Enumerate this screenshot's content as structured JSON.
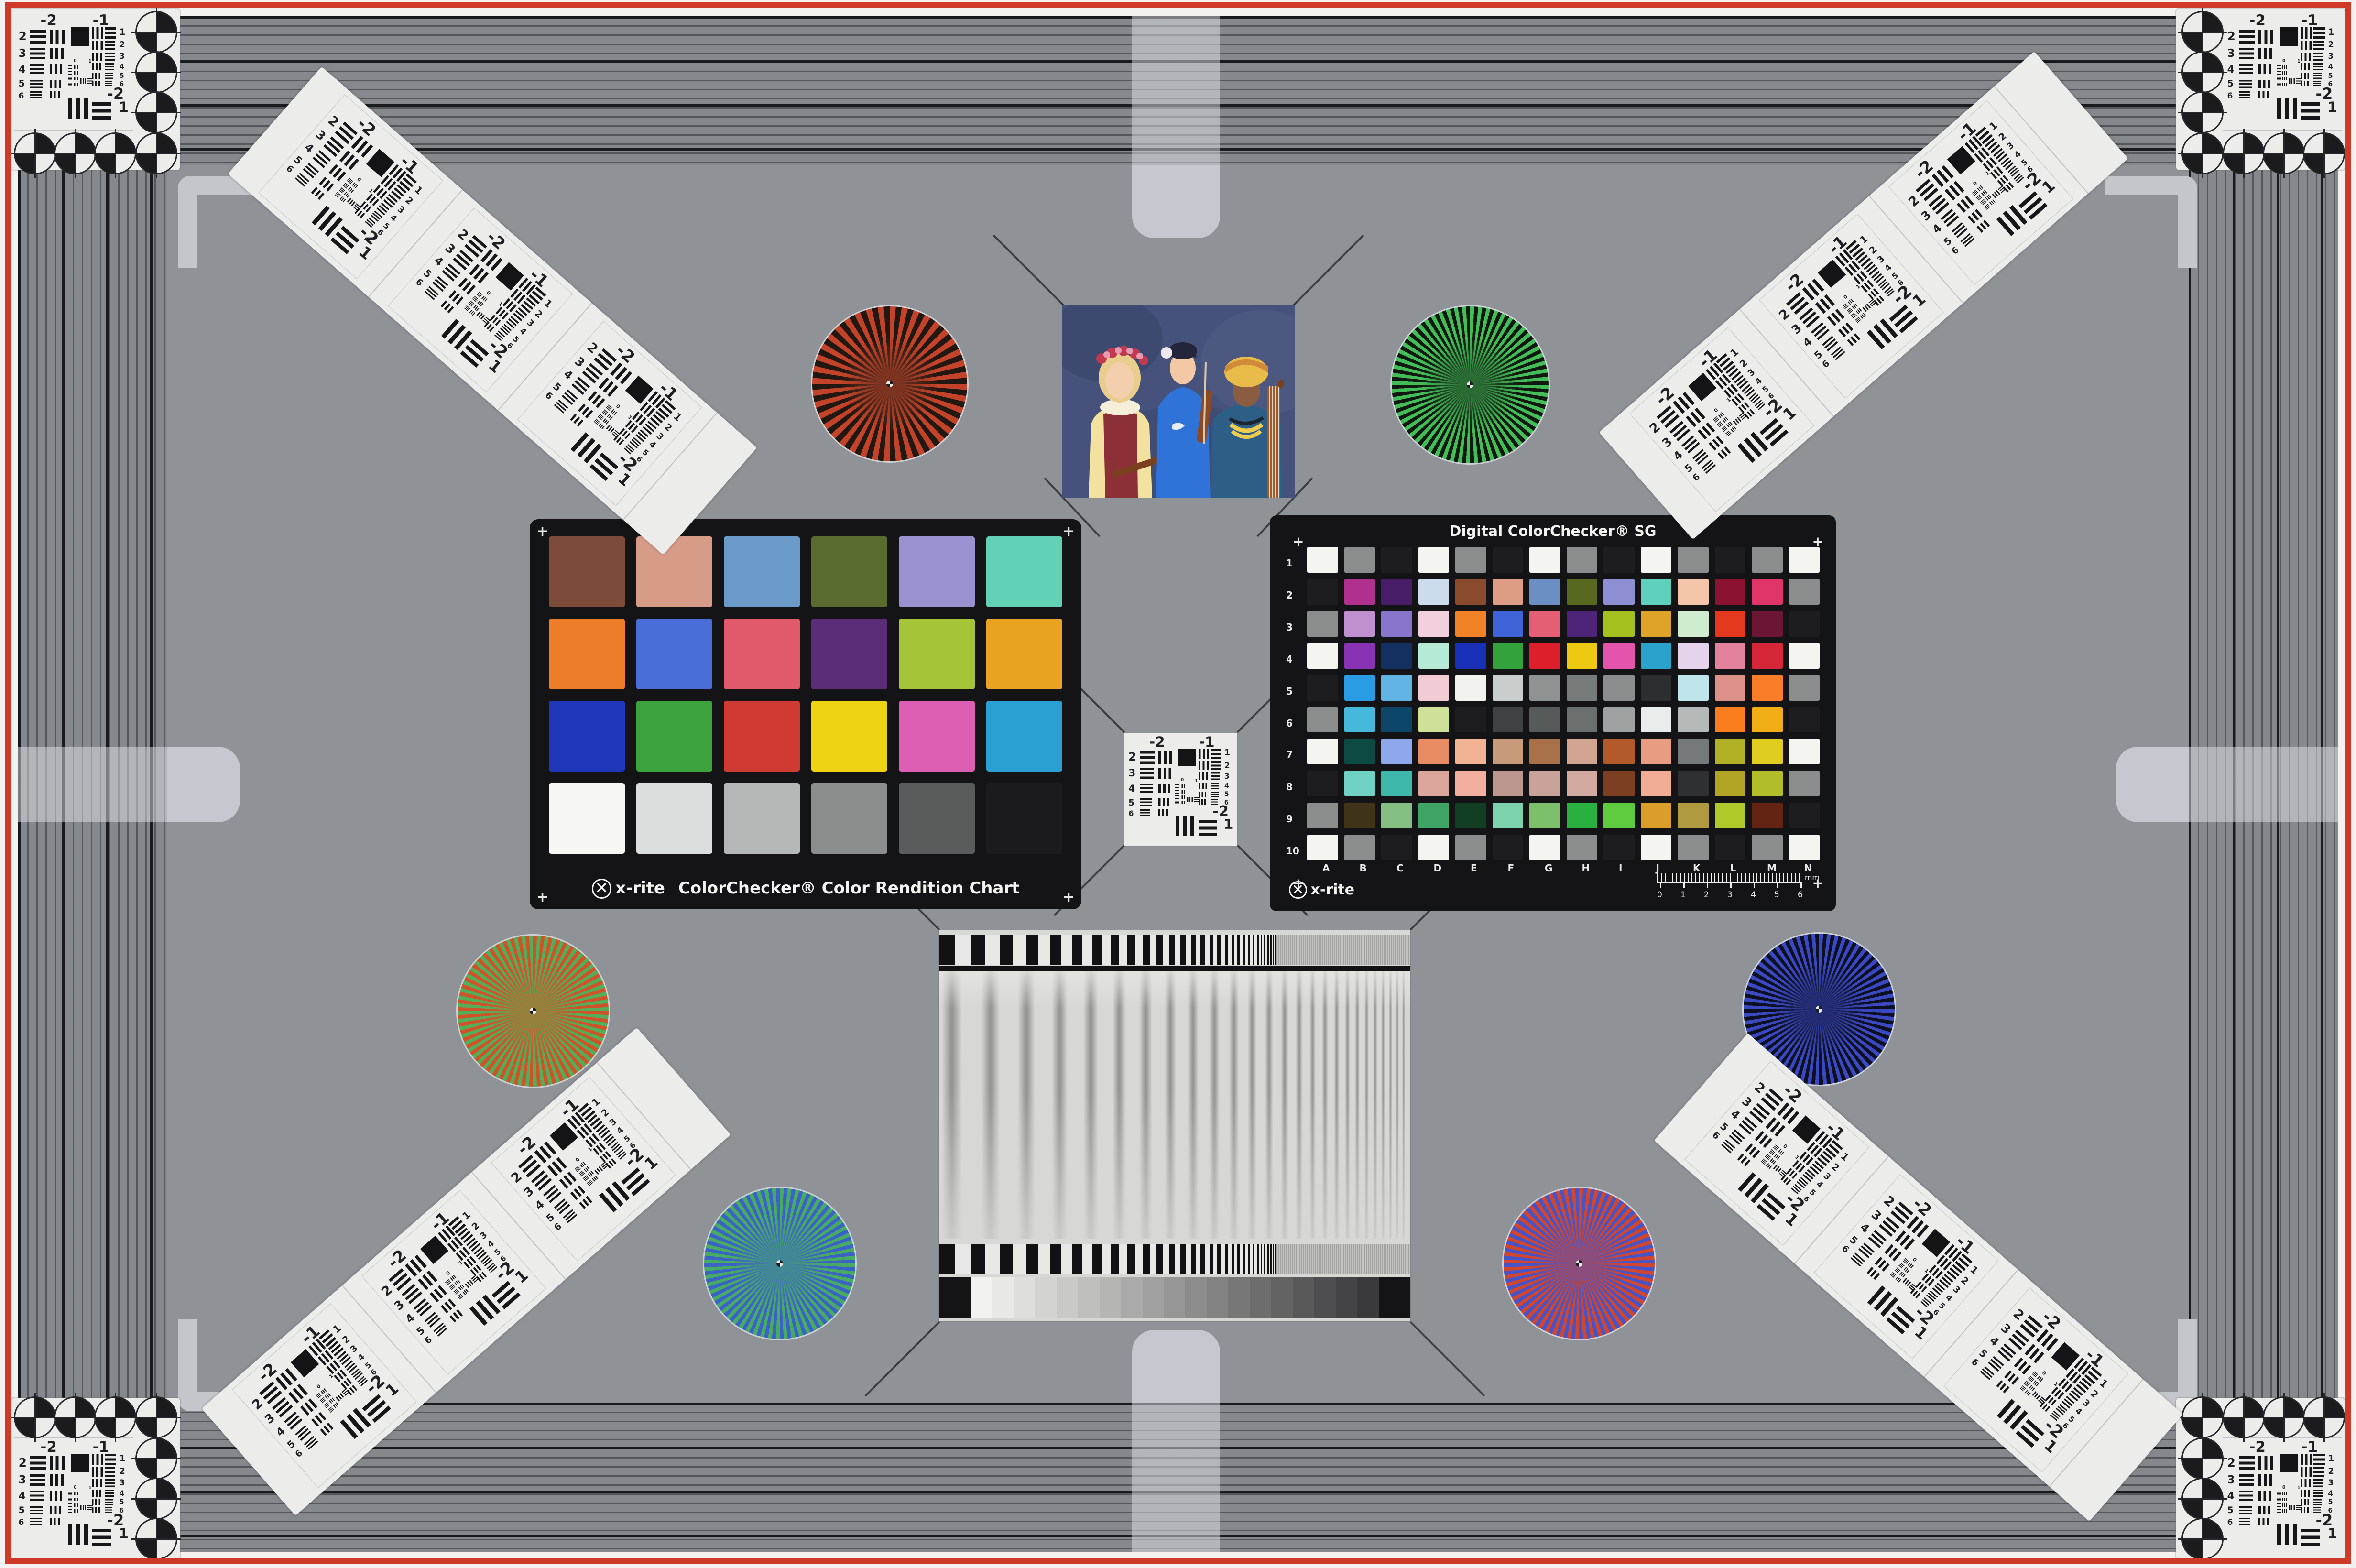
{
  "page": {
    "background": "#f3f2f0",
    "field_color": "#8f9297",
    "frame_red": "#cf3a28",
    "band_base": "#85888d",
    "tab_color": "#c5c9cf"
  },
  "usaf": {
    "top_left": "-2",
    "top_right": "-1",
    "left_labels": [
      "2",
      "3",
      "4",
      "5",
      "6"
    ],
    "right_labels": [
      "1",
      "2",
      "3",
      "4",
      "5",
      "6"
    ],
    "bottom_labels": [
      "-2",
      "1"
    ],
    "mini_labels": [
      "0",
      "1"
    ]
  },
  "colorchecker": {
    "brand": "x-rite",
    "title": "ColorChecker® Color Rendition Chart",
    "patches": [
      [
        "#7d4b39",
        "#d79c87",
        "#6a9bc8",
        "#5a6c2d",
        "#9a92d0",
        "#63d1b5"
      ],
      [
        "#ee7d2a",
        "#4a6ed8",
        "#e15a6c",
        "#5b2d79",
        "#a6c438",
        "#eaa221"
      ],
      [
        "#2036bb",
        "#3ca23e",
        "#cf3a33",
        "#eed315",
        "#dd5fb4",
        "#2a9fd3"
      ],
      [
        "#f6f6f3",
        "#dcdedd",
        "#b5b8b7",
        "#8b8e8d",
        "#585c5b",
        "#1b1b1d"
      ]
    ]
  },
  "sg": {
    "title": "Digital ColorChecker® SG",
    "brand": "x-rite",
    "rows": [
      "1",
      "2",
      "3",
      "4",
      "5",
      "6",
      "7",
      "8",
      "9",
      "10"
    ],
    "columns": [
      "A",
      "B",
      "C",
      "D",
      "E",
      "F",
      "G",
      "H",
      "I",
      "J",
      "K",
      "L",
      "M",
      "N"
    ],
    "ruler_ticks": [
      "0",
      "1",
      "2",
      "3",
      "4",
      "5",
      "6"
    ],
    "ruler_unit": "mm",
    "patches": [
      [
        "#f4f4f1",
        "#8a8d8c",
        "#1d1d1f",
        "#f4f4f1",
        "#8a8d8c",
        "#1d1d1f",
        "#f4f4f1",
        "#8a8d8c",
        "#1d1d1f",
        "#f4f4f1",
        "#8a8d8c",
        "#1d1d1f",
        "#8a8d8c",
        "#f4f4f1"
      ],
      [
        "#1d1d1f",
        "#b0308f",
        "#461d66",
        "#ccdcec",
        "#8a4a2d",
        "#dd9c84",
        "#6b8fc2",
        "#56691f",
        "#8d8fd2",
        "#5fd0bb",
        "#f4c6a9",
        "#8c1231",
        "#e03568",
        "#8a8d8c"
      ],
      [
        "#8a8d8c",
        "#c08fd0",
        "#8a75cc",
        "#f2cfdd",
        "#f28227",
        "#3f64d8",
        "#e45f74",
        "#4d2478",
        "#a3c01f",
        "#e0a32a",
        "#cfecd0",
        "#e5391f",
        "#6d1534",
        "#1d1d1f"
      ],
      [
        "#f4f4f1",
        "#8832b4",
        "#143061",
        "#b5ead7",
        "#1831b8",
        "#34a23c",
        "#dc1f2a",
        "#eec913",
        "#e454ad",
        "#2aa2cc",
        "#e4d3ea",
        "#e2829c",
        "#d62739",
        "#f4f4f1"
      ],
      [
        "#1d1d1f",
        "#2a9ce4",
        "#62b4e4",
        "#f2ccd4",
        "#f2f2ee",
        "#c9cdcc",
        "#8e9291",
        "#777b7a",
        "#8a8d8c",
        "#2c2e30",
        "#bfe4ec",
        "#dc9289",
        "#fa7e2a",
        "#8a8d8c"
      ],
      [
        "#8a8d8c",
        "#45b8dc",
        "#0d4668",
        "#cfe098",
        "#1d1d1f",
        "#3f4142",
        "#565a59",
        "#6b6f6e",
        "#9ea2a1",
        "#e8eceb",
        "#b5b9b8",
        "#fa7e1e",
        "#f2ae17",
        "#1d1d1f"
      ],
      [
        "#f4f4f1",
        "#0d4a44",
        "#8fa8ec",
        "#e88c64",
        "#f2b294",
        "#c79b7a",
        "#a8714a",
        "#d2a492",
        "#b35a2a",
        "#e89c82",
        "#76797b",
        "#b2b025",
        "#e0cd1f",
        "#f4f4f1"
      ],
      [
        "#1d1d1f",
        "#6fd2c4",
        "#3fb8ac",
        "#dca69c",
        "#f2ae9e",
        "#bc9790",
        "#c9a29a",
        "#d2a99e",
        "#7c3f21",
        "#f0ad94",
        "#2e3032",
        "#b2a525",
        "#b2bd2a",
        "#8a8d8c"
      ],
      [
        "#8a8d8c",
        "#3f3319",
        "#84c083",
        "#3fa465",
        "#123f23",
        "#7cd2ac",
        "#7cc06b",
        "#2ab03f",
        "#5fcc3f",
        "#dc9e2a",
        "#b09a3f",
        "#aec929",
        "#642414",
        "#1d1d1f"
      ],
      [
        "#f4f4f1",
        "#8a8d8c",
        "#1d1d1f",
        "#f4f4f1",
        "#8a8d8c",
        "#1d1d1f",
        "#f4f4f1",
        "#8a8d8c",
        "#1d1d1f",
        "#f4f4f1",
        "#8a8d8c",
        "#1d1d1f",
        "#8a8d8c",
        "#f4f4f1"
      ]
    ]
  },
  "stars": [
    {
      "name": "red-black",
      "a": "#c2432a",
      "b": "#231711",
      "half": 4.5,
      "core": "#7c3420"
    },
    {
      "name": "green-black",
      "a": "#43bd58",
      "b": "#10190f",
      "half": 3,
      "core": "#2a6b33"
    },
    {
      "name": "red-green",
      "a": "#d05229",
      "b": "#54ad58",
      "half": 3,
      "core": "#97803c"
    },
    {
      "name": "blue-black",
      "a": "#3a49c1",
      "b": "#0d0f23",
      "half": 3,
      "core": "#232c72"
    },
    {
      "name": "green-blue",
      "a": "#48ab64",
      "b": "#3b63c5",
      "half": 3,
      "core": "#418795"
    },
    {
      "name": "red-blue",
      "a": "#d0462e",
      "b": "#4654c8",
      "half": 3,
      "core": "#8b4d7b"
    }
  ],
  "grayscale_wedge": {
    "steps": 19,
    "from": "#f2f2f0",
    "to": "#3a3a3c",
    "end_block": "#141416"
  }
}
